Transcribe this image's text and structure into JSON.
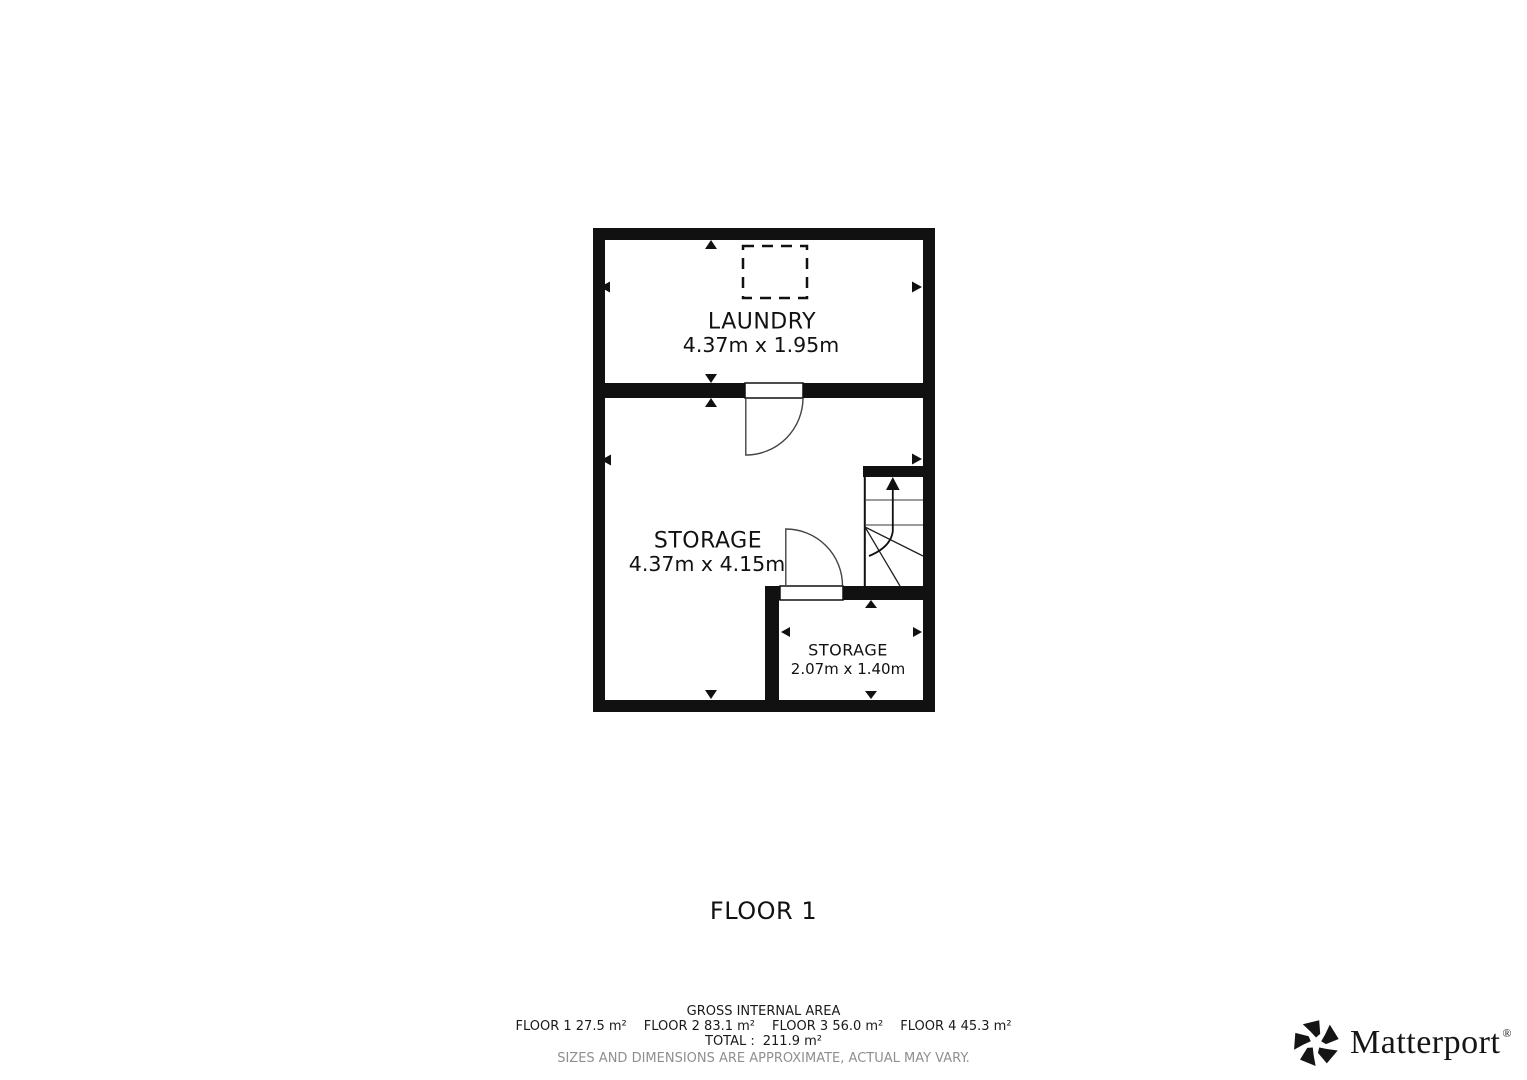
{
  "plan": {
    "title": "FLOOR 1",
    "rooms": [
      {
        "name": "LAUNDRY",
        "dims": "4.37m x 1.95m"
      },
      {
        "name": "STORAGE",
        "dims": "4.37m x 4.15m"
      },
      {
        "name": "STORAGE",
        "dims": "2.07m x 1.40m"
      }
    ]
  },
  "footer": {
    "heading": "GROSS INTERNAL AREA",
    "floors": [
      {
        "label": "FLOOR 1",
        "area": "27.5 m²"
      },
      {
        "label": "FLOOR 2",
        "area": "83.1 m²"
      },
      {
        "label": "FLOOR 3",
        "area": "56.0 m²"
      },
      {
        "label": "FLOOR 4",
        "area": "45.3 m²"
      }
    ],
    "total_label": "TOTAL :",
    "total_value": "211.9 m²",
    "disclaimer": "SIZES AND DIMENSIONS ARE APPROXIMATE, ACTUAL MAY VARY."
  },
  "branding": {
    "name": "Matterport",
    "registered": "®"
  },
  "colors": {
    "wall": "#111111",
    "background": "#ffffff",
    "muted": "#8f8f8f"
  }
}
